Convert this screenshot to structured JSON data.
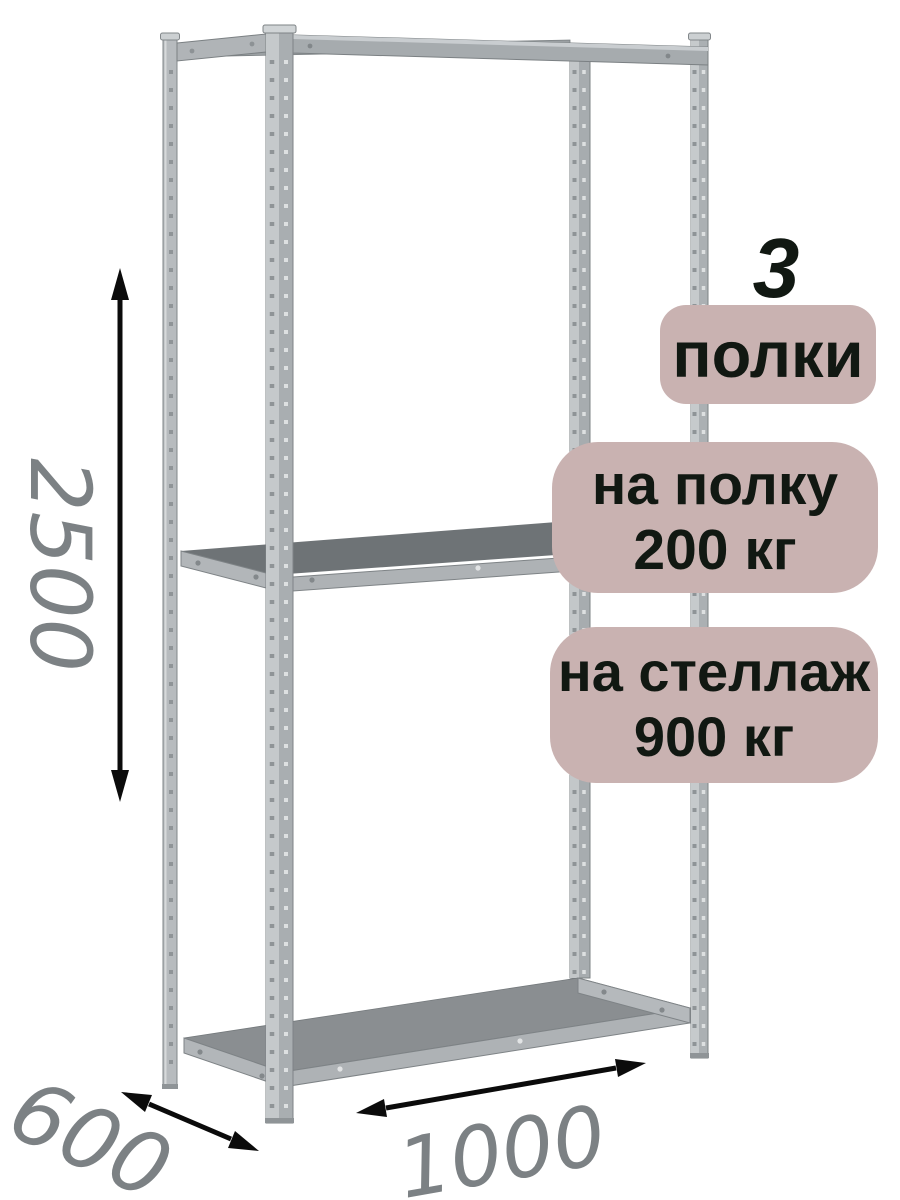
{
  "annotations": {
    "shelf_count": "3",
    "badges": {
      "shelves": {
        "label": "полки"
      },
      "per_shelf": {
        "line1": "на полку",
        "line2": "200 кг"
      },
      "per_rack": {
        "line1": "на стеллаж",
        "line2": "900 кг"
      }
    },
    "dimensions": {
      "height": "2500",
      "depth": "600",
      "width": "1000"
    }
  },
  "colors": {
    "background": "#ffffff",
    "badge_bg": "#c9b2b1",
    "badge_text": "#111812",
    "dimension_text": "#7c8184",
    "arrow": "#0b0b0b",
    "metal_dark_top": "#6e7376",
    "shelf_top": "#8a8e91"
  }
}
